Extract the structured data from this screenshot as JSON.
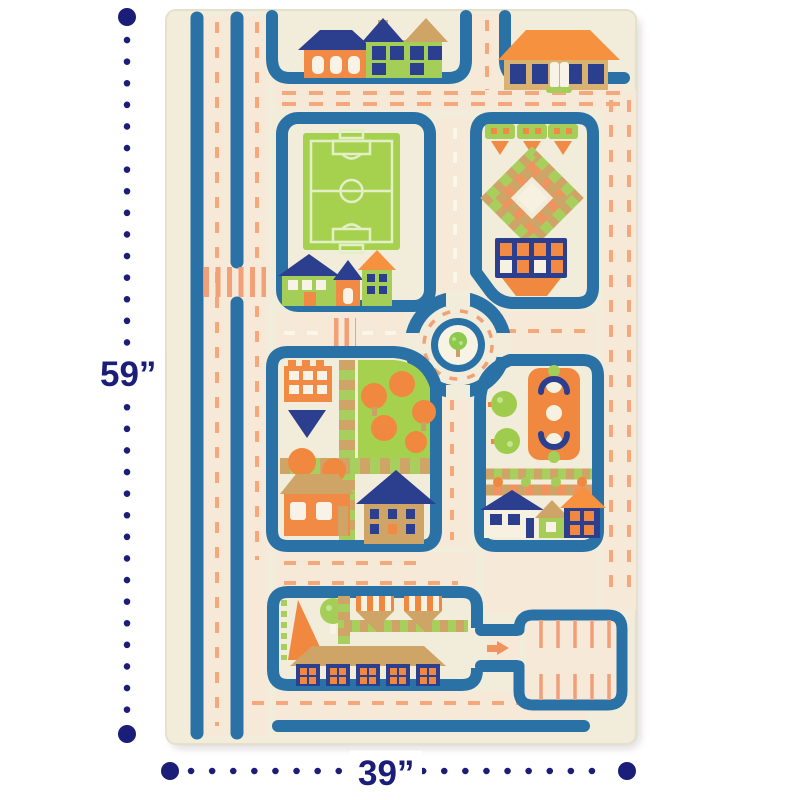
{
  "product_viewer": {
    "dimensions": {
      "height_label": "59”",
      "width_label": "39”"
    },
    "rug": {
      "features": [
        "toy-houses-row",
        "soccer-field",
        "garden-diamond-park",
        "roundabout-with-tree",
        "city-block",
        "playground-block",
        "market-block",
        "parking-lot",
        "two-lane-roads",
        "crosswalks"
      ],
      "palette": {
        "annotation_navy": "#1b1e78",
        "rug_cream": "#f2ecda",
        "road_blue": "#2a72a6",
        "detail_navy": "#2b3f8e",
        "accent_orange": "#f08a45",
        "grass_green": "#a6d14f",
        "tan": "#cfa467",
        "dash_orange": "#f4a87c",
        "off_white": "#f8f3e6"
      }
    }
  }
}
